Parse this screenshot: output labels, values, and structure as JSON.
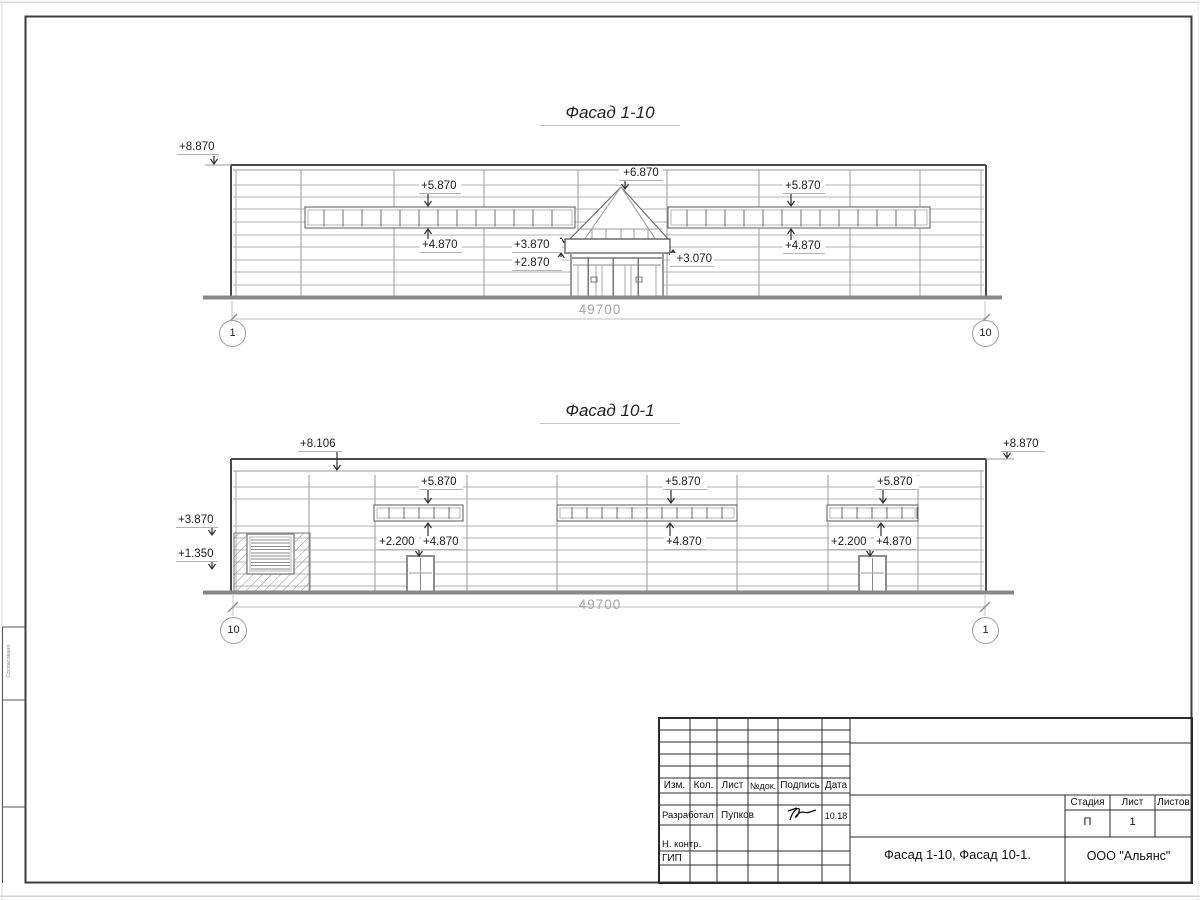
{
  "colors": {
    "line_dark": "#4a4a4a",
    "line_mid": "#9b9b9b",
    "line_light": "#b3b3b3",
    "ground": "#888888",
    "dim_text": "#a3a3a3"
  },
  "facade1": {
    "title": "Фасад 1-10",
    "dimension": "49700",
    "axis_left": "1",
    "axis_right": "10",
    "marks": {
      "m8870": "+8.870",
      "m5870L": "+5.870",
      "m6870": "+6.870",
      "m5870R": "+5.870",
      "m4870L": "+4.870",
      "m3870": "+3.870",
      "m2870": "+2.870",
      "m3070": "+3.070",
      "m4870R": "+4.870"
    }
  },
  "facade2": {
    "title": "Фасад 10-1",
    "dimension": "49700",
    "axis_left": "10",
    "axis_right": "1",
    "marks": {
      "m8106": "+8.106",
      "m8870": "+8.870",
      "m5870A": "+5.870",
      "m5870B": "+5.870",
      "m5870C": "+5.870",
      "m4870A": "+4.870",
      "m4870B": "+4.870",
      "m4870C": "+4.870",
      "m2200A": "+2.200",
      "m2200C": "+2.200",
      "m3870L": "+3.870",
      "m1350": "+1.350"
    }
  },
  "title_block": {
    "headers": {
      "izm": "Изм.",
      "kol": "Кол.",
      "list": "Лист",
      "ndok": "№док.",
      "podpis": "Подпись",
      "data": "Дата"
    },
    "rows": {
      "razrabotal": "Разработал",
      "developer_name": "Пупков",
      "date": "10.18",
      "nkontr": "Н. контр.",
      "gip": "ГИП"
    },
    "stadia_label": "Стадия",
    "list_label": "Лист",
    "listov_label": "Листов",
    "stadia_value": "П",
    "list_value": "1",
    "doc_title": "Фасад 1-10, Фасад 10-1.",
    "org_name": "ООО \"Альянс\""
  },
  "margin_note": "Согласовано"
}
